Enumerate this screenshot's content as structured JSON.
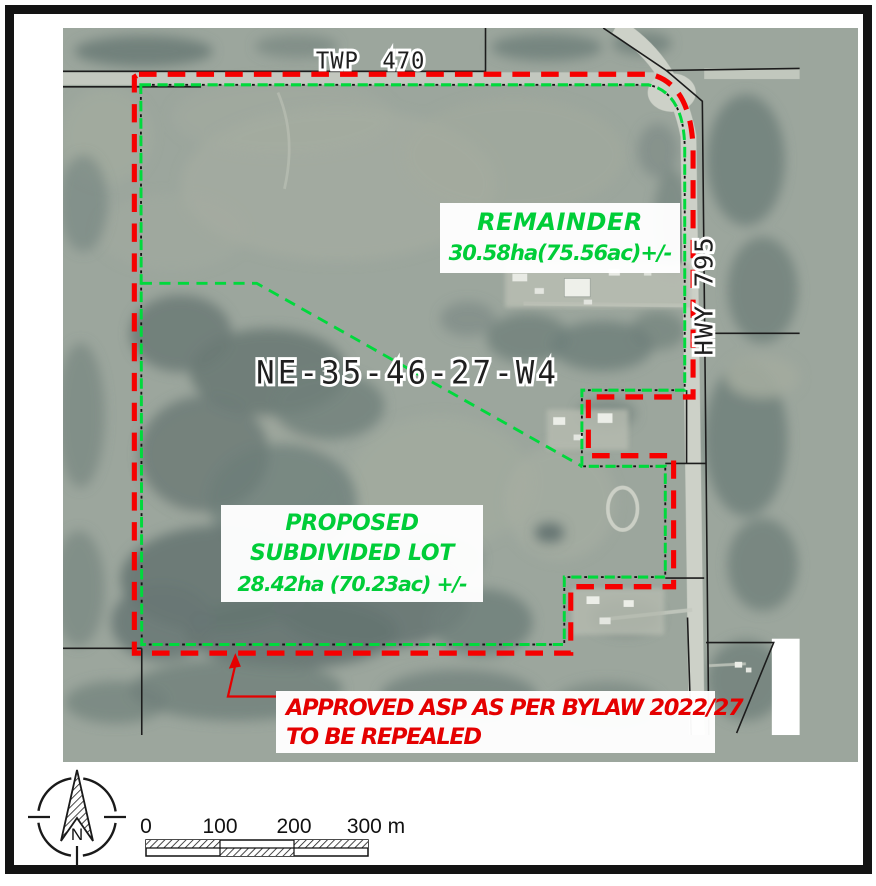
{
  "map": {
    "road_labels": {
      "township_road": "TWP 470",
      "highway": "HWY 795"
    },
    "quarter_section": "NE-35-46-27-W4",
    "remainder": {
      "title": "REMAINDER",
      "area": "30.58ha(75.56ac)+/-"
    },
    "proposed_lot": {
      "line1": "PROPOSED",
      "line2": "SUBDIVIDED LOT",
      "line3": "28.42ha (70.23ac) +/-"
    },
    "repeal_note": {
      "line1": "APPROVED ASP AS PER BYLAW 2022/27",
      "line2": "TO BE REPEALED"
    }
  },
  "legend": {
    "north_label": "N",
    "scale_ticks": [
      "0",
      "100",
      "200",
      "300 m"
    ]
  },
  "colors": {
    "asp_boundary_red": "#f60000",
    "subdivision_green": "#00d93c",
    "note_red": "#e40000",
    "label_green": "#00cd38",
    "photo_base": "#9ca69d",
    "frame_black": "#131313"
  }
}
